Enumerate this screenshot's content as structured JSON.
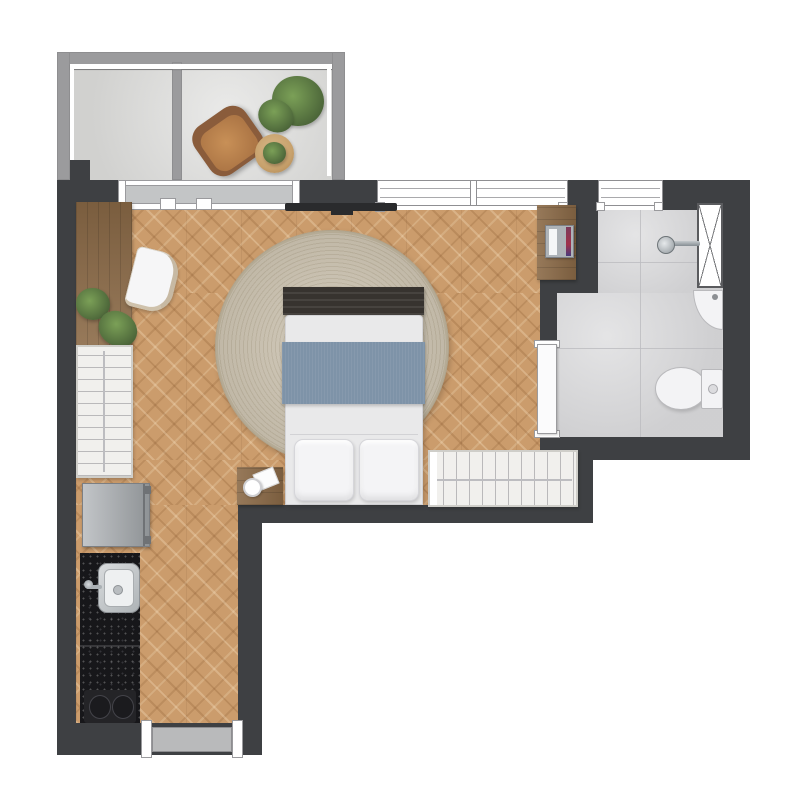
{
  "plan": {
    "kind": "studio-apartment-floor-plan",
    "palette": {
      "wall_dark": "#3e4043",
      "balcony_wall": "#9b9b9d",
      "wood_floor": "#cb9c6c",
      "tile_floor": "#d6d6d8",
      "balcony_floor": "#dcdcda",
      "rug_beige": "#cbc2b0",
      "blanket_blue": "#7e93a8",
      "counter_black": "#17171a",
      "wood_furniture": "#8b6a47",
      "mattress_white": "#e9e9ea",
      "closet_white": "#f1f0ed",
      "fixture_white": "#f3f3f5",
      "metal_gray": "#9aa0a5",
      "fridge_gray": "#a6aaae",
      "tv_black": "#2a2b2d",
      "leather_brown": "#bb8355",
      "leather_rim": "#8a5c3b",
      "plant_green": "#5d7f47",
      "door_slab_gray": "#b9babb",
      "glass_gray": "#c3c5c6",
      "rattan_tan": "#c8a26d"
    },
    "rooms": [
      {
        "name": "balcony",
        "items": [
          "lounge-armchair",
          "potted-plant-large",
          "rattan-side-table",
          "table-plant",
          "glass-railing"
        ]
      },
      {
        "name": "bedroom-living",
        "items": [
          "wall-tv",
          "round-rug",
          "double-bed",
          "bed-footboard-bench",
          "blue-blanket",
          "pillow-left",
          "pillow-right",
          "nightstand",
          "cup",
          "note-card",
          "console-desk",
          "desk-chair",
          "indoor-plants",
          "wardrobe-left",
          "closet-hanging",
          "corner-desk",
          "laptop-and-books"
        ]
      },
      {
        "name": "kitchen",
        "items": [
          "refrigerator",
          "granite-counter",
          "stainless-sink",
          "sink-faucet",
          "cooktop-two-burners",
          "entry-door"
        ]
      },
      {
        "name": "bathroom",
        "items": [
          "tile-floor",
          "shower-head",
          "duct-shaft",
          "corner-washbasin",
          "toilet-bowl",
          "toilet-tank",
          "flush-button",
          "sliding-door"
        ]
      }
    ],
    "openings": [
      "balcony-sliding-glass-door",
      "bedroom-window",
      "bathroom-window",
      "bathroom-sliding-door",
      "entry-door"
    ]
  }
}
